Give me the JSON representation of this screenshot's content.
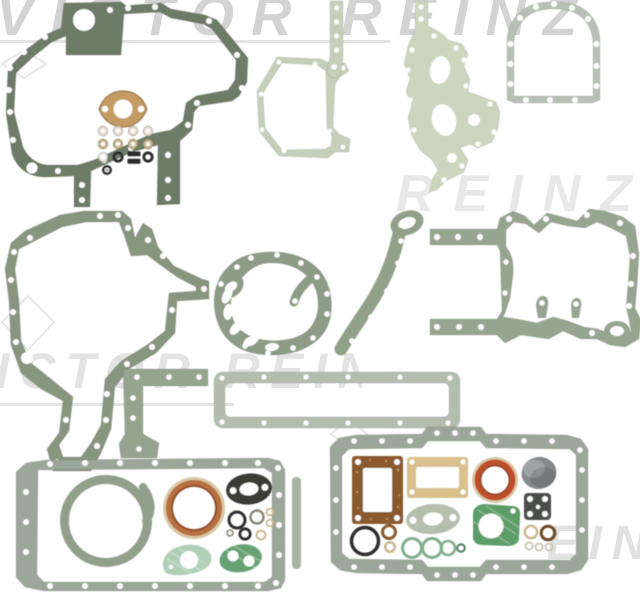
{
  "canvas": {
    "width": 640,
    "height": 595,
    "background": "#ffffff"
  },
  "brand_watermark": {
    "text": "VICTOR REINZ",
    "color": "#c9c9c9",
    "line_color": "#e4e4e4",
    "instances": [
      "top",
      "middle-right",
      "middle-left",
      "bottom-right-fragment"
    ]
  },
  "parts": {
    "front_cover": {
      "color": "#6d7b66"
    },
    "timing_housing": {
      "color": "#87967f"
    },
    "pump_gasket": {
      "color": "#8d9c86"
    },
    "crescent_gasket": {
      "color": "#90a089"
    },
    "timing_case": {
      "color": "#96a58f"
    },
    "corner_gasket": {
      "color": "#95a48e"
    },
    "side_cover_frame": {
      "color": "#b3bdad"
    },
    "oil_pan_left": {
      "color": "#9ba798"
    },
    "oil_pan_right": {
      "color": "#9ba798"
    },
    "seal_retainer_ring": {
      "color": "#91a08b"
    },
    "octagon_cover": {
      "color": "#c6cfba"
    },
    "strip_gasket": {
      "color": "#c6cfba"
    },
    "side_plate": {
      "color": "#ccd5bd"
    },
    "arch_cover": {
      "color": "#b7c0b4"
    },
    "copper_flange": {
      "color": "#c39b63",
      "outline": "#8a6a3f"
    },
    "washers": {
      "cream": "#e3ddd0",
      "tan": "#c8b28a",
      "black": "#2c2c2a",
      "white": "#efeee8",
      "outline": "#b0aa9c"
    },
    "seal_left": {
      "rim": "#d8c8a6",
      "body": "#b8703f",
      "inner": "#8f4a22"
    },
    "seal_right": {
      "rim": "#d8c8a6",
      "body": "#bf4f2a",
      "inner": "#8f3a1e"
    },
    "black_oval": {
      "color": "#3b3b39"
    },
    "mint_gasket": {
      "color": "#aecfb6"
    },
    "green_two_hole": {
      "color": "#66a273"
    },
    "cork_rect": {
      "color": "#8a5a2e",
      "speck": "#c89a5e"
    },
    "manila_rect": {
      "color": "#d9c08c"
    },
    "cup_plug": {
      "color": "#85898b"
    },
    "square_plate": {
      "color": "#4b4e4b"
    },
    "green_square": {
      "color": "#5c9d69"
    },
    "green_ring": {
      "color": "#7fae89"
    },
    "dark_green_ring": {
      "color": "#4e7d5a"
    },
    "tan_ring": {
      "color": "#cbb691"
    },
    "brown_ring": {
      "color": "#8a5a2e"
    },
    "dark_brown_ring": {
      "color": "#6b4a28"
    },
    "dark_ring": {
      "color": "#2f2f2d"
    },
    "gray_ring": {
      "color": "#8a8678"
    },
    "pale_ring": {
      "color": "#c9c4b4"
    },
    "pale_oval": {
      "color": "#b4bfae"
    },
    "sliver_strip": {
      "color": "#aab4a6"
    },
    "hole": {
      "color": "#ffffff"
    }
  }
}
